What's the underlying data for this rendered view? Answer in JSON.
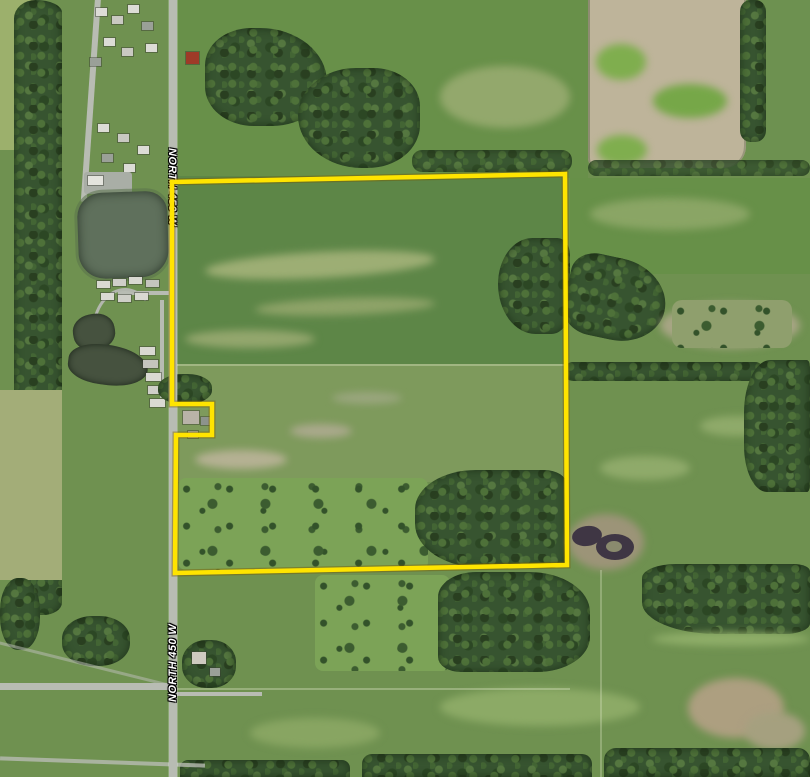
{
  "map": {
    "road_labels": [
      {
        "id": "north-450-w-upper",
        "text": "NORTH 450 W"
      },
      {
        "id": "north-450-w-lower",
        "text": "NORTH 450 W"
      }
    ],
    "parcel": {
      "outline_color": "#FFE400",
      "outline_halo_color": "rgba(120,92,0,0.45)",
      "outline_width": 4.5,
      "vertices_px": [
        [
          172,
          182
        ],
        [
          565,
          174
        ],
        [
          567,
          565
        ],
        [
          175,
          573
        ],
        [
          176,
          435
        ],
        [
          212,
          435
        ],
        [
          212,
          404
        ],
        [
          172,
          404
        ]
      ]
    },
    "label_text_color": "#FFFFFF"
  }
}
